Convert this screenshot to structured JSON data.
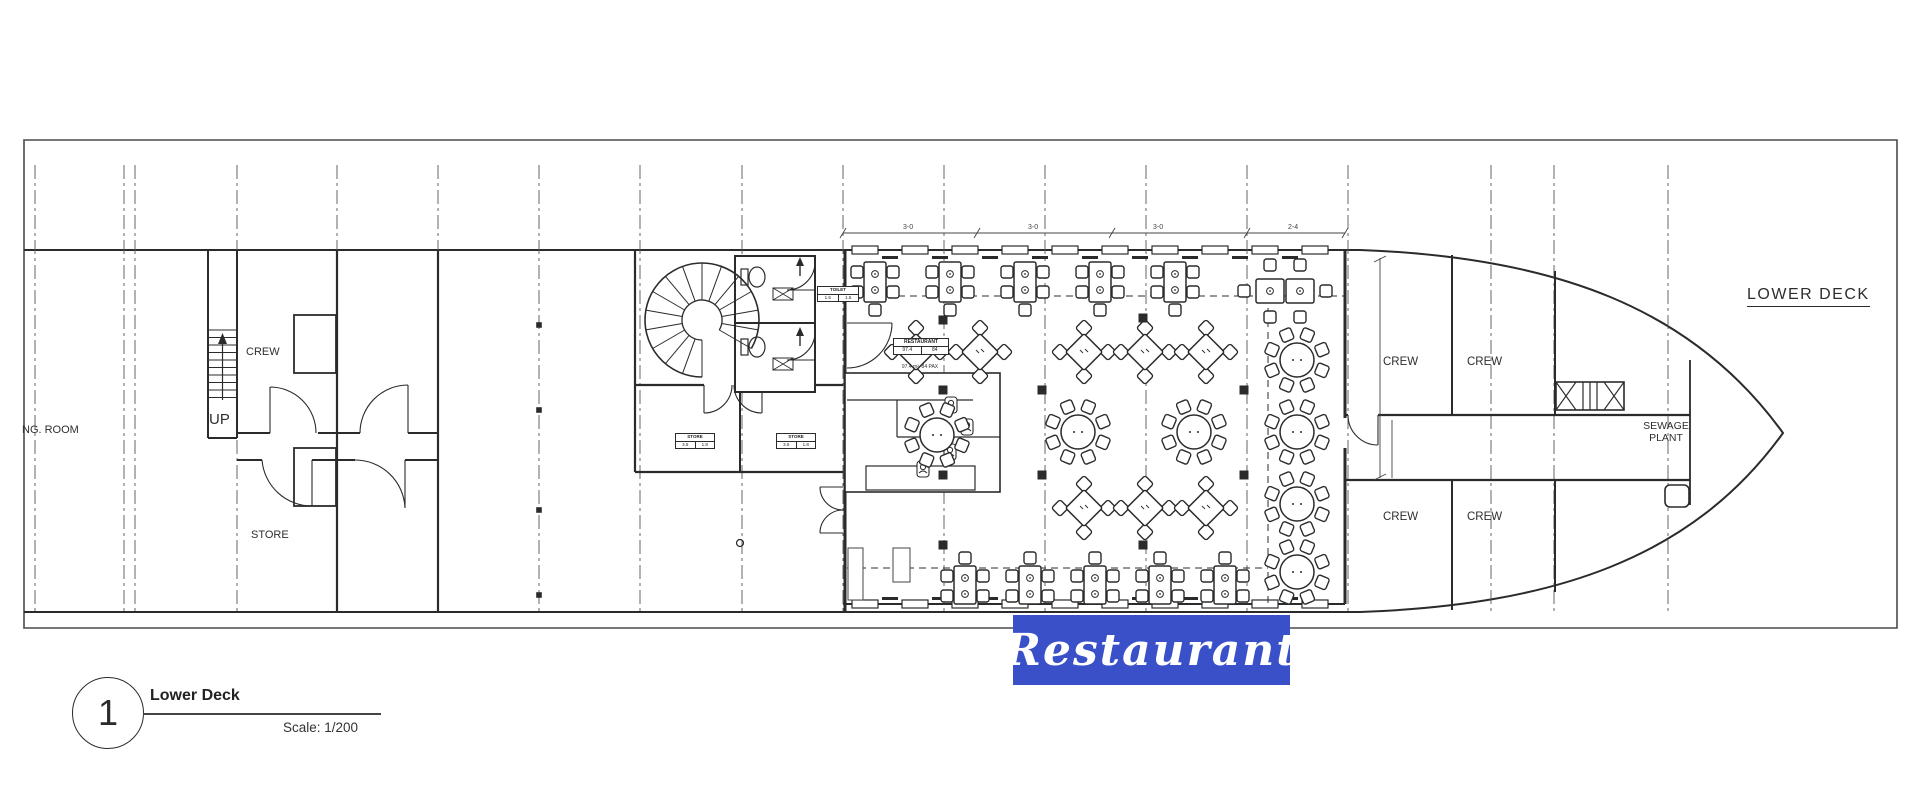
{
  "banner": {
    "text": "Restaurant",
    "bg": "#3a50c8",
    "fg": "#ffffff"
  },
  "deck_title": "LOWER DECK",
  "sheet": {
    "number": "1",
    "name": "Lower Deck",
    "scale": "Scale: 1/200"
  },
  "rooms": {
    "ng_room": "NG. ROOM",
    "crew_stern": "CREW",
    "up": "UP",
    "store": "STORE",
    "crew_bow": [
      "CREW",
      "CREW",
      "CREW",
      "CREW"
    ],
    "sewage_1": "SEWAGE",
    "sewage_2": "PLANT"
  },
  "tags": {
    "restaurant": {
      "line1": "RESTAURANT",
      "cell_a": "97.4",
      "cell_b": "84",
      "line3": "97.4 m²  84 PAX"
    },
    "store_a": {
      "line1": "STORE",
      "cell_a": "3.5",
      "cell_b": "1.8"
    },
    "store_b": {
      "line1": "STORE",
      "cell_a": "3.5",
      "cell_b": "1.8"
    },
    "wc": {
      "line1": "TOILET",
      "cell_a": "1.5",
      "cell_b": "1.5"
    }
  },
  "colors": {
    "ink": "#2b2b2b",
    "grid": "#555555",
    "frame": "#4a4a4a"
  },
  "plan": {
    "grid_x": [
      35,
      124,
      135,
      237,
      337,
      438,
      539,
      640,
      742,
      843,
      944,
      1045,
      1146,
      1247,
      1348,
      1491,
      1554,
      1668
    ],
    "grid_markers_sq": [
      [
        539,
        325
      ],
      [
        539,
        410
      ],
      [
        539,
        510
      ],
      [
        539,
        595
      ]
    ],
    "grid_marker_circle": [
      740,
      543
    ],
    "pillars": [
      [
        943,
        320
      ],
      [
        943,
        390
      ],
      [
        943,
        475
      ],
      [
        943,
        545
      ],
      [
        1143,
        318
      ],
      [
        1143,
        545
      ],
      [
        1042,
        390
      ],
      [
        1042,
        475
      ],
      [
        1244,
        390
      ],
      [
        1244,
        475
      ]
    ],
    "dim_labels": [
      "3-0",
      "3-0",
      "3-0",
      "2-4"
    ],
    "tables": {
      "top_row_x": [
        875,
        950,
        1025,
        1100,
        1175
      ],
      "bottom_row_x": [
        965,
        1030,
        1095,
        1160,
        1225
      ],
      "diamond_row1": {
        "y": 352,
        "x": [
          916,
          980,
          1084,
          1145,
          1206
        ]
      },
      "diamond_row2": {
        "y": 508,
        "x": [
          1084,
          1145,
          1206
        ]
      },
      "round_mid": [
        [
          937,
          435
        ],
        [
          1078,
          432
        ],
        [
          1194,
          432
        ]
      ],
      "round_right": [
        [
          1297,
          360
        ],
        [
          1297,
          432
        ],
        [
          1297,
          504
        ],
        [
          1297,
          572
        ]
      ]
    }
  }
}
